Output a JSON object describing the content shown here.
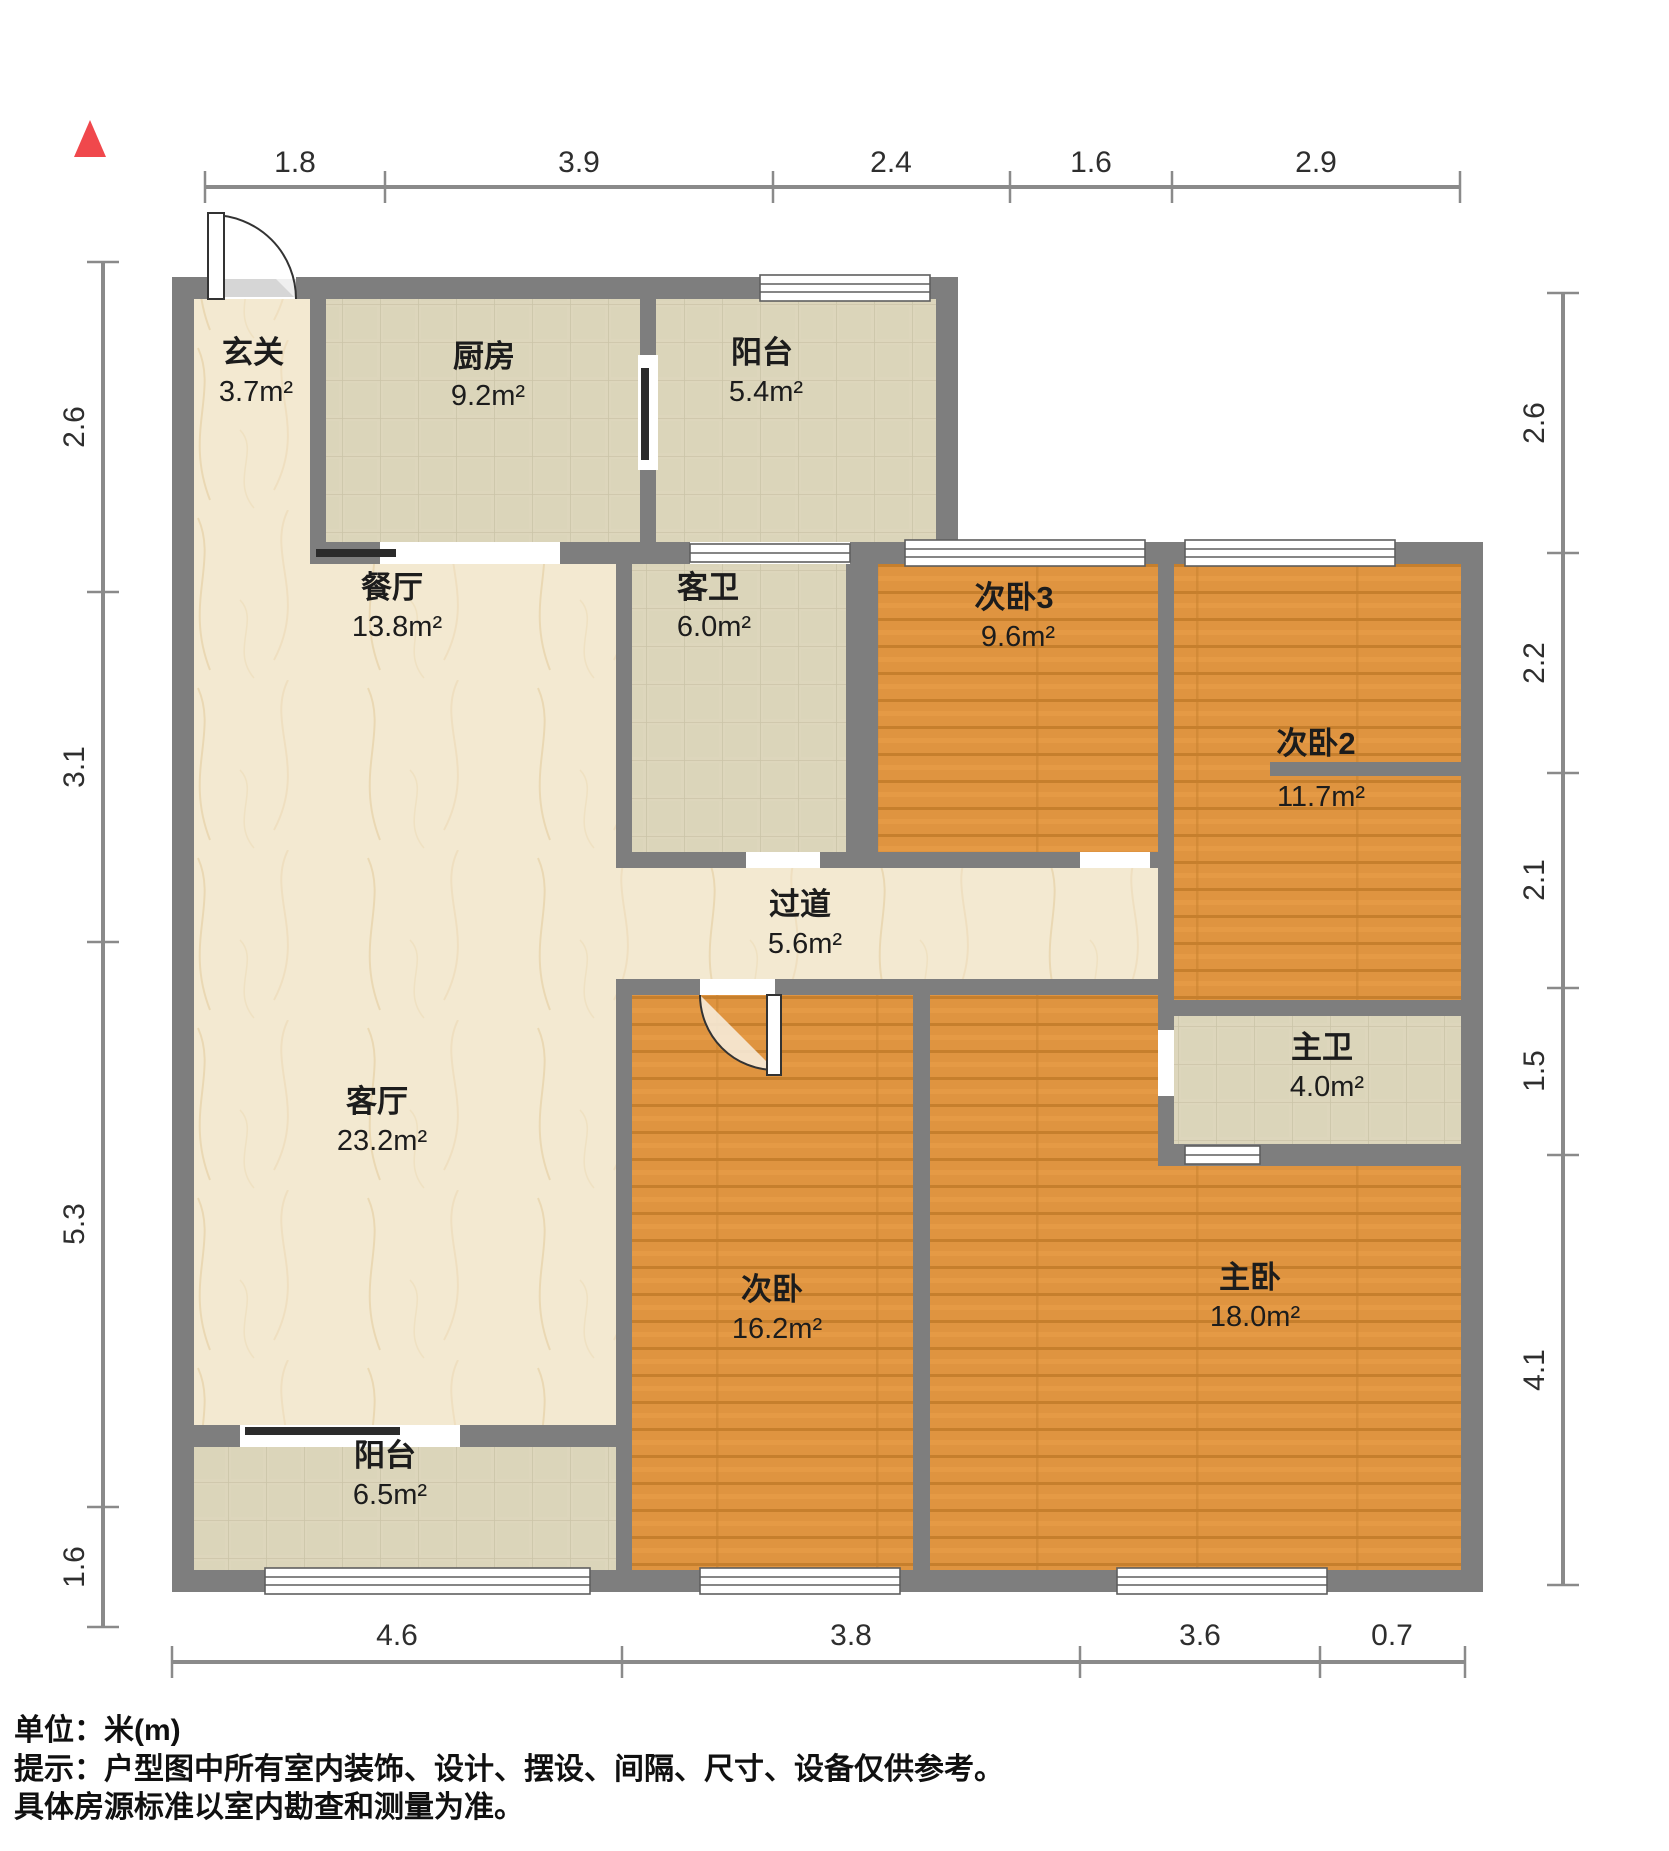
{
  "title": "户型图",
  "unit_system": "米(m)",
  "north_indicator": "north-arrow",
  "rooms": [
    {
      "id": "xuanguan",
      "name": "玄关",
      "area": "3.7m²"
    },
    {
      "id": "chufang",
      "name": "厨房",
      "area": "9.2m²"
    },
    {
      "id": "yangtai_n",
      "name": "阳台",
      "area": "5.4m²"
    },
    {
      "id": "canting",
      "name": "餐厅",
      "area": "13.8m²"
    },
    {
      "id": "kewei",
      "name": "客卫",
      "area": "6.0m²"
    },
    {
      "id": "ciwo3",
      "name": "次卧3",
      "area": "9.6m²"
    },
    {
      "id": "ciwo2",
      "name": "次卧2",
      "area": "11.7m²"
    },
    {
      "id": "guodao",
      "name": "过道",
      "area": "5.6m²"
    },
    {
      "id": "keting",
      "name": "客厅",
      "area": "23.2m²"
    },
    {
      "id": "zhuwei",
      "name": "主卫",
      "area": "4.0m²"
    },
    {
      "id": "ciwo",
      "name": "次卧",
      "area": "16.2m²"
    },
    {
      "id": "zhuwo",
      "name": "主卧",
      "area": "18.0m²"
    },
    {
      "id": "yangtai_s",
      "name": "阳台",
      "area": "6.5m²"
    }
  ],
  "dimensions": {
    "top": [
      "1.8",
      "3.9",
      "2.4",
      "1.6",
      "2.9"
    ],
    "left": [
      "2.6",
      "3.1",
      "5.3",
      "1.6"
    ],
    "right": [
      "2.6",
      "2.2",
      "2.1",
      "1.5",
      "4.1"
    ],
    "bottom": [
      "4.6",
      "3.8",
      "3.6",
      "0.7"
    ]
  },
  "footer": {
    "unit_label": "单位：米(m)",
    "notice_line1": "提示：户型图中所有室内装饰、设计、摆设、间隔、尺寸、设备仅供参考。",
    "notice_line2": "具体房源标准以室内勘查和测量为准。"
  },
  "colors": {
    "wall": "#7e7e7e",
    "north_arrow_red": "#f0484c",
    "marble_floor": "#f3e9d1",
    "tile_floor": "#ddd6bc",
    "wood_floor": "#df9440",
    "dim_line": "#8a8a8a",
    "text": "#1c1c1c",
    "background": "#ffffff"
  }
}
